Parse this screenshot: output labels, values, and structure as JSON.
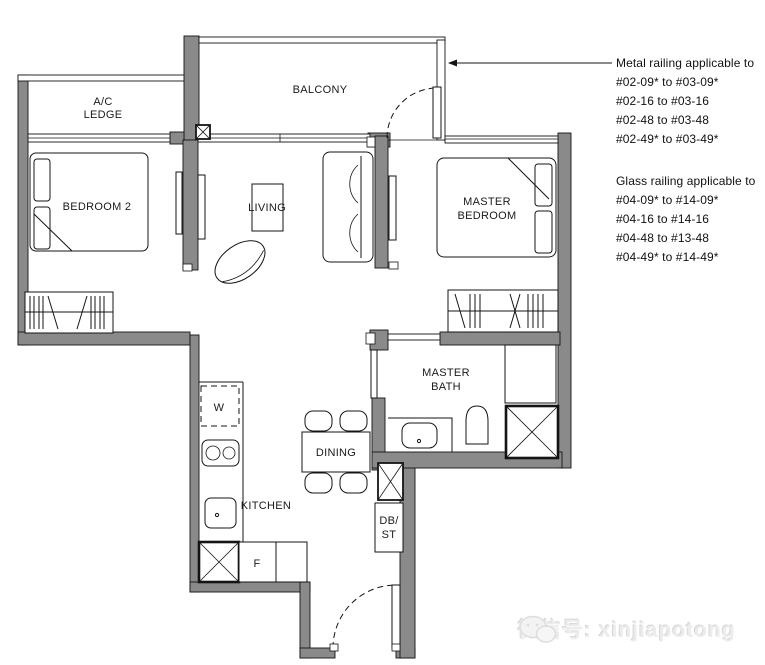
{
  "plan": {
    "rooms": {
      "ac_ledge_l1": "A/C",
      "ac_ledge_l2": "LEDGE",
      "balcony": "BALCONY",
      "bedroom2": "BEDROOM 2",
      "living": "LIVING",
      "master_bedroom_l1": "MASTER",
      "master_bedroom_l2": "BEDROOM",
      "master_bath_l1": "MASTER",
      "master_bath_l2": "BATH",
      "dining": "DINING",
      "kitchen": "KITCHEN",
      "washer": "W",
      "fridge": "F",
      "db_l1": "DB/",
      "db_l2": "ST"
    }
  },
  "annotations": {
    "metal": {
      "title": "Metal railing applicable to",
      "lines": [
        "#02-09* to #03-09*",
        "#02-16 to #03-16",
        "#02-48 to #03-48",
        "#02-49* to #03-49*"
      ]
    },
    "glass": {
      "title": "Glass railing applicable to",
      "lines": [
        "#04-09* to #14-09*",
        "#04-16 to #14-16",
        "#04-48 to #13-48",
        "#04-49* to #14-49*"
      ]
    }
  },
  "watermark": {
    "text": "微信号: xinjiapotong"
  },
  "colors": {
    "wall": "#8a8a8a",
    "line": "#141414",
    "text": "#1a1a1a",
    "watermark": "#ececec"
  }
}
